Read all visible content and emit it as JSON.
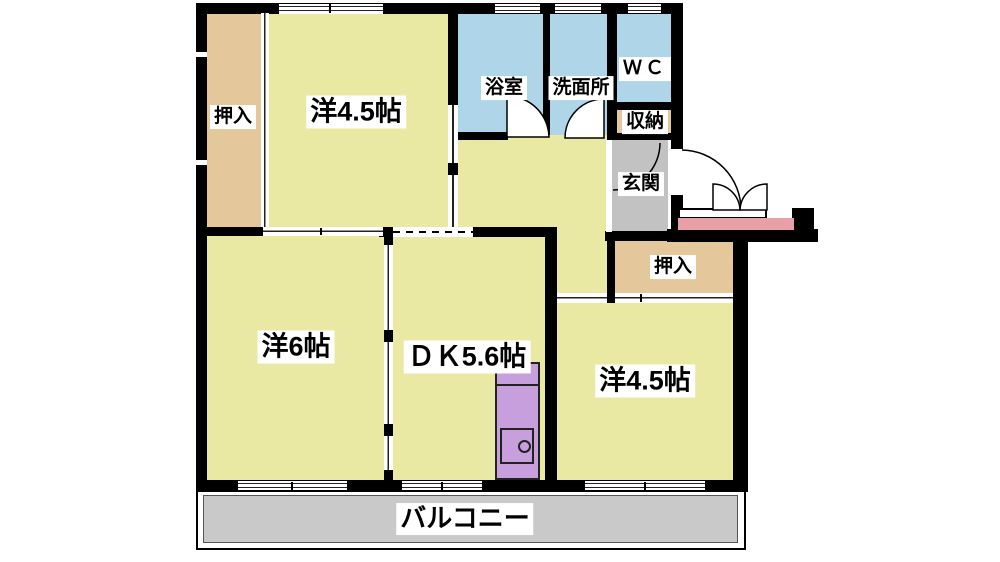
{
  "floorplan": {
    "labels": {
      "closet_top_left": "押入",
      "bedroom_top": "洋4.5帖",
      "bathroom": "浴室",
      "washroom": "洗面所",
      "toilet": "ＷＣ",
      "storage": "収納",
      "entrance": "玄関",
      "closet_right": "押入",
      "bedroom_left": "洋6帖",
      "dining_kitchen": "ＤＫ5.6帖",
      "bedroom_right": "洋4.5帖",
      "balcony": "バルコニー"
    },
    "colors": {
      "room_floor": "#e9e9a4",
      "closet_floor": "#e5c79c",
      "wet_area_floor": "#aed6e8",
      "entrance_floor": "#c2c2c2",
      "balcony_floor": "#c9c9c9",
      "porch_strip": "#e8a0a6",
      "kitchen_counter": "#c79fdd",
      "wall": "#000000"
    }
  }
}
